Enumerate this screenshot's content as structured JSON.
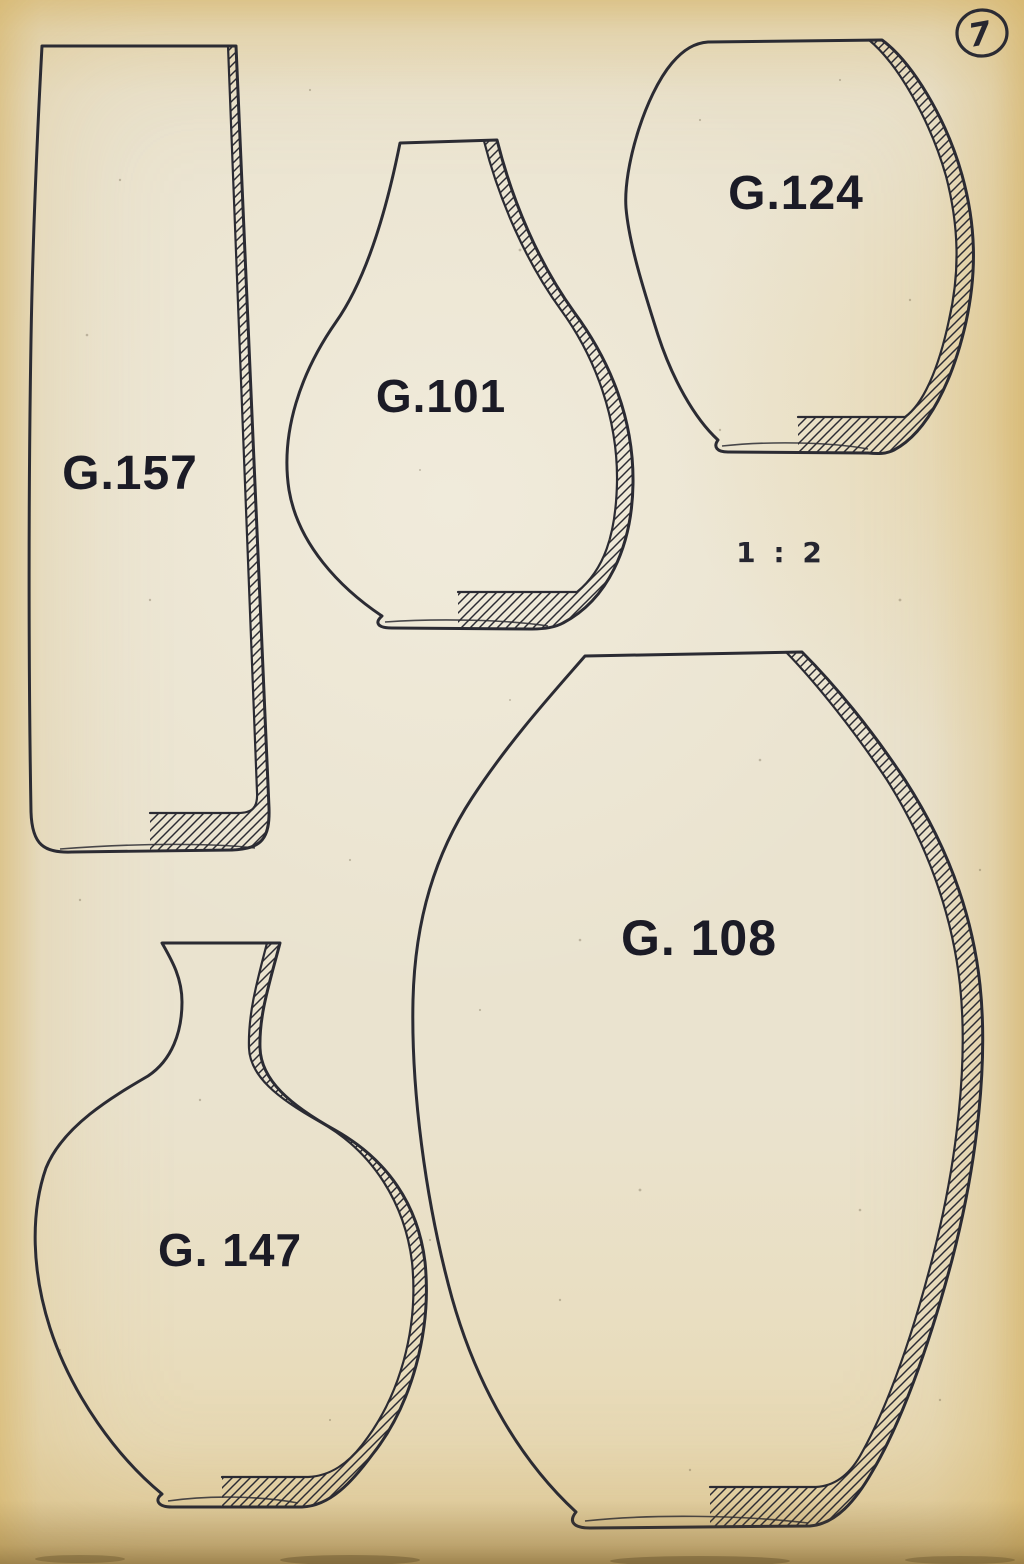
{
  "page": {
    "number": "7",
    "scale_label": "1 : 2"
  },
  "figures": [
    {
      "label": "G.157"
    },
    {
      "label": "G.101"
    },
    {
      "label": "G.124"
    },
    {
      "label": "G. 147"
    },
    {
      "label": "G. 108"
    }
  ],
  "colors": {
    "ink": "#2b2b33",
    "label_ink": "#1b1b26",
    "paper_center": "#eae3cf",
    "paper_edge": "#e6d098"
  }
}
